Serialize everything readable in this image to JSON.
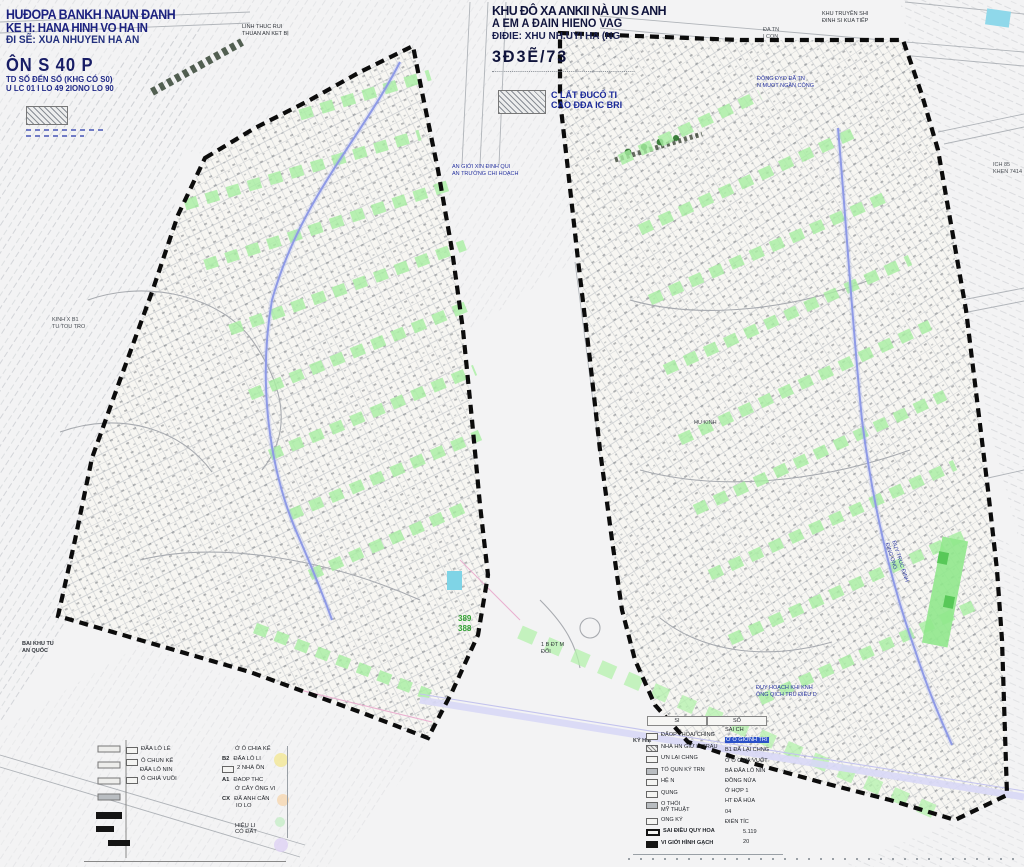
{
  "title_left": {
    "l1": "HUĐOPA BANKH NAUN ĐANH",
    "l2": "KE H: HANA HINH VO HA IN",
    "l3": "ĐI SẼ: XUA NHUYEN HA AN",
    "l4": "ÔN S 40 P",
    "l5": "TD SỐ ĐẾN SỐ  (KHG CÓ S0)",
    "l6": "U LC 01 I LO 49 2IONO LO 90"
  },
  "title_center": {
    "l1": "KHU ĐÔ XA ANKII NÀ UN S ANH",
    "l2": "A EM A ĐAIN HIENO VAG",
    "l3": "ĐIĐIE: XHU NH.UYI HA (NG",
    "l4": "3Đ3Ẽ/73"
  },
  "hatch_note": {
    "l1": "C LẤT ĐUCỐ TI",
    "l2": "CAO ĐĐA IC BRI"
  },
  "map_labels": {
    "road_top": {
      "l1": "LINH THUC RUI",
      "l2": "THUAN AN KET BỊ"
    },
    "boundary_mid": {
      "l1": "AN GIỚI XIN ĐINH QUI",
      "l2": "AN TRƯỜNG CHI HOẠCH"
    },
    "da_tn": {
      "l1": "ĐA TN",
      "l2": "I CON"
    },
    "dyke": {
      "l1": "ĐỘNG ĐYO ĐÃ TN",
      "l2": "N MUOT NGẦN CÔNG"
    },
    "top_right": {
      "l1": "KHU TRUYỀN SHI",
      "l2": "ĐINH SI KUA TIẾP"
    },
    "ich": {
      "l1": "ICH 85",
      "l2": "KHEN 7414 MS"
    },
    "kinh": {
      "l1": "KINH X B1",
      "l2": "TU TOU TRO"
    },
    "bai": {
      "l1": "BAI KHU TU",
      "l2": "AN QUỐC"
    },
    "lot_389": "389",
    "lot_388": "388",
    "bdtm": {
      "l1": "1 B ĐT M",
      "l2": "ĐỐI"
    },
    "duy_hoach": {
      "l1": "ĐUY HOẠCH KHI KNH",
      "l2": "ÔNG QICH TRU ĐIỀU D"
    },
    "truc": {
      "l1": "ĐUY TRUC ĐINH",
      "l2": "ĐING ONG"
    },
    "hu_kinh": "HU KINH"
  },
  "legend_left": {
    "col1": [
      {
        "label": "ĐẤA LÔ LẺ"
      },
      {
        "label": "Ô CHUN KẾ",
        "sub": "ĐẤA LÔ NIN"
      },
      {
        "label": "Ô CHIẢ VUỒI"
      }
    ],
    "col2": [
      {
        "label": "Ở Ô CHIA KẾ"
      },
      {
        "code": "B2",
        "label": "ĐẤA LÔ LI"
      },
      {
        "label": "2 NHÀ ỒN"
      },
      {
        "code": "A1",
        "label": "ĐAOP THC"
      },
      {
        "label": "Ở CÂY ỐNG VI"
      },
      {
        "code": "CX",
        "label": "ĐẤ ANH CÂN",
        "sub": "IO LO"
      },
      {
        "label": "HIỆU LI",
        "sub": "CÓ ĐẤT"
      }
    ]
  },
  "legend_right": {
    "header": {
      "c1": "SI",
      "c2": "SỐ"
    },
    "side_label": "KÝ HIỆ",
    "col_a": [
      "ĐẤOP THỔAI CHÌNG",
      "NHÀ HN GIỮ LI TRAU",
      "ƯN LẠI CHNG",
      "TỔ QUN KÝ TRN",
      "HỆ N",
      "QUNG",
      "O THỔI",
      "MỸ THUẬT",
      "ONG KÝ",
      "SAI ĐIỀU QUY HOA",
      "VI GIỚI HÌNH GẠCH"
    ],
    "col_b": [
      "SAI CH",
      "Ở Ô GIỚNH TRI",
      "B1  ĐẤ LẠI CHNG",
      "Ở Ô CHIẢ VUỐT",
      "BẢ  ĐẤA LÔ NIN",
      "ĐỒNG NỬA",
      "Ở HỢP 1",
      "HT  ĐẤ HÙA",
      "04",
      "ĐIỂN TÍC",
      "5.119",
      "20"
    ]
  },
  "colors": {
    "block_border": "#0c0c0c",
    "green_strip": "#a8efa2",
    "water_blue": "#9aa6ee",
    "road_lavender": "#d8d8f6",
    "title_blue": "#1c2280",
    "highlight_blue": "#2a50c8"
  }
}
